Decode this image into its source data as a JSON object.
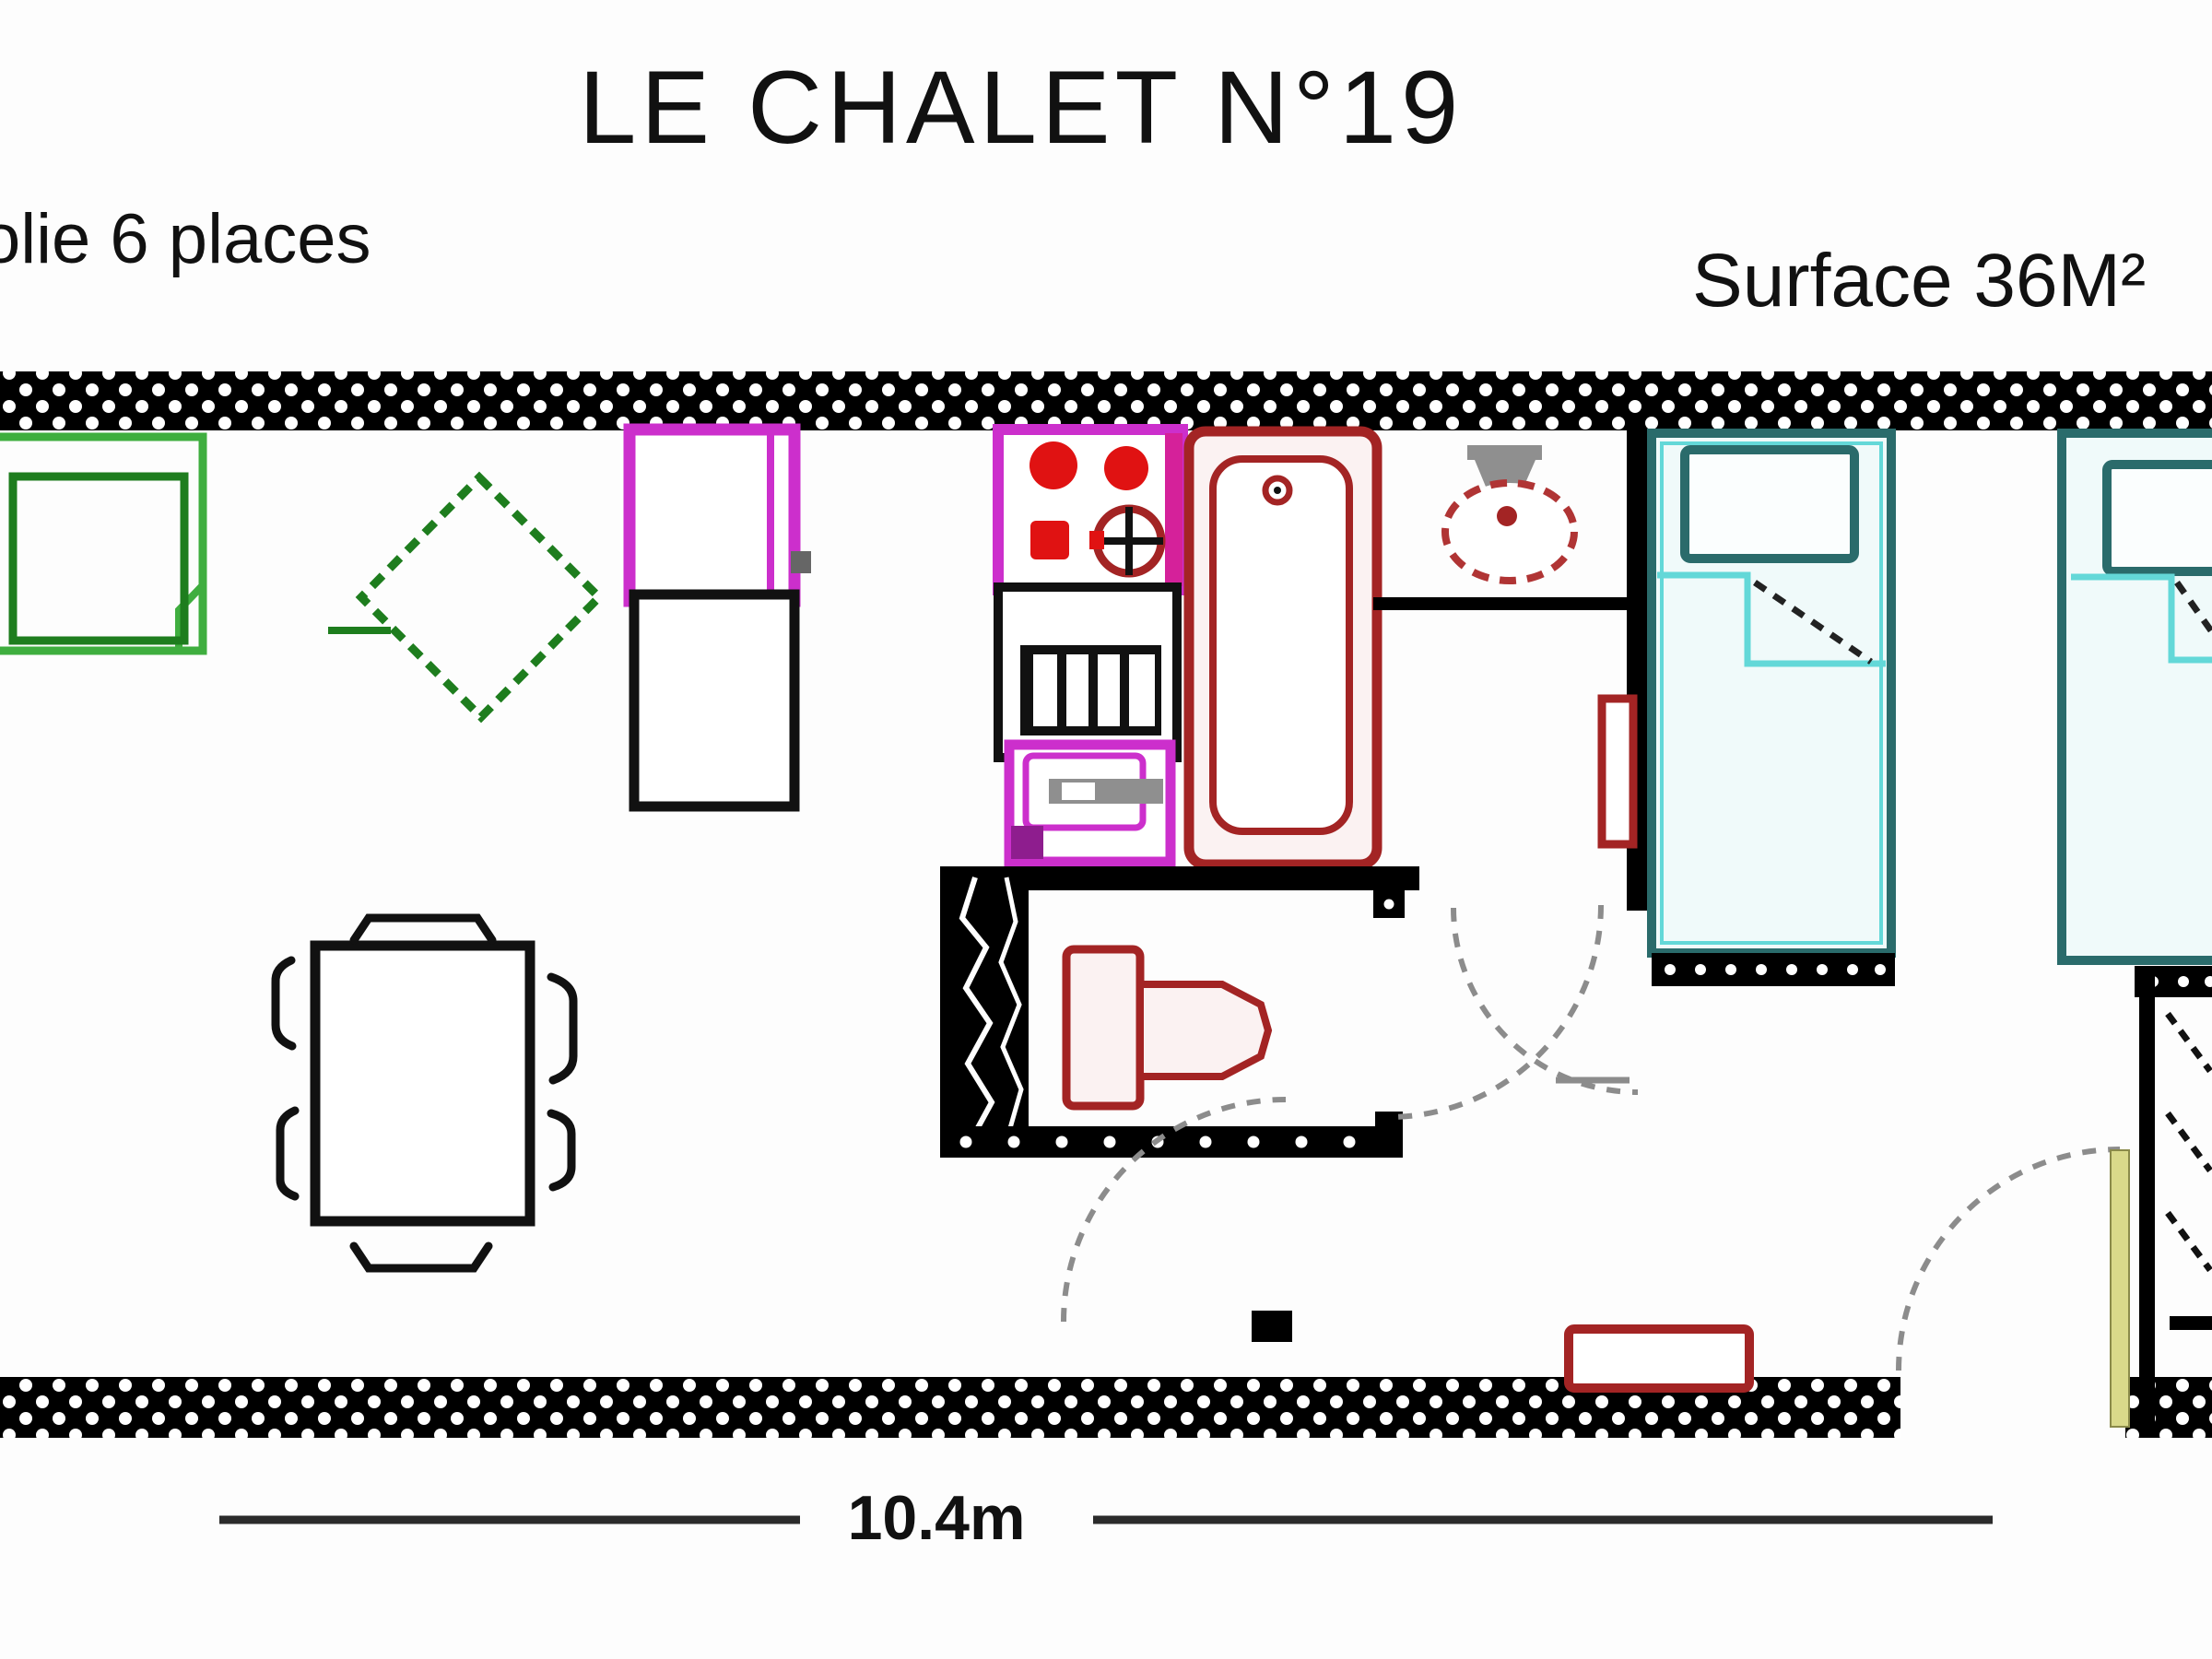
{
  "title": "LE CHALET N°19",
  "labels": {
    "capacity": "olie 6 places",
    "surface": "Surface 36M²",
    "length": "10.4m"
  },
  "palette": {
    "wall": "#000000",
    "sofa_light": "#3fae3f",
    "sofa_dark": "#1e7d1e",
    "magenta": "#cc2fcc",
    "magenta_deep": "#d5219a",
    "purple_dark": "#8e1d8e",
    "red": "#e01212",
    "dark_red": "#a32424",
    "bath_fill": "#fbf2f2",
    "teal": "#2a6b6b",
    "cyan": "#63d8d8",
    "bed_fill": "#f0fafa",
    "gray": "#8f8f8f",
    "door_yellow": "#d9d98a",
    "arc": "#8c8c8c",
    "text": "#111111"
  }
}
